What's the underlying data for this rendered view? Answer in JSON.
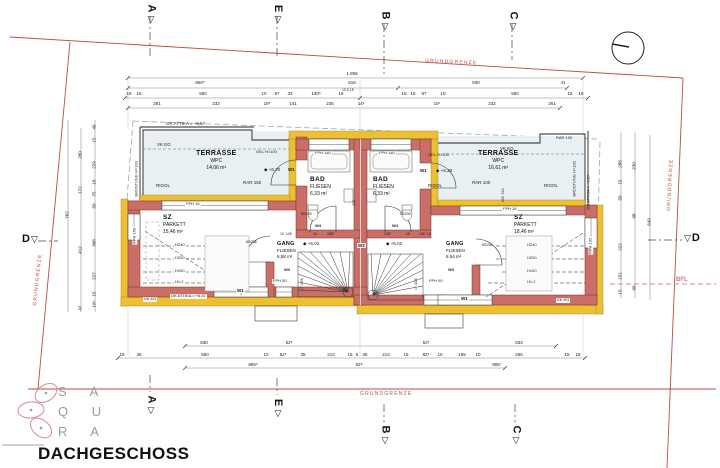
{
  "title": "DACHGESCHOSS",
  "logo": {
    "rows": [
      "S A",
      "Q U",
      "R A"
    ]
  },
  "boundary": {
    "grundgrenze_top": "GRUNDGRENZE",
    "grundgrenze_right": "GRUNDGRENZE",
    "grundgrenze_bottom": "GRUNDGRENZE",
    "grundgrenze_left": "GRUNDGRENZE",
    "bfl": "BFL"
  },
  "colors": {
    "wall": "#c96f68",
    "wall_outline": "#7a2f28",
    "insulation": "#edc033",
    "boundary": "#bf4a44",
    "bfl_line": "#e08a9a",
    "roof_dashed": "#85aec9",
    "terrace_floor": "#e9f0f4"
  },
  "section_markers": {
    "top": [
      {
        "label": "A"
      },
      {
        "label": "E"
      },
      {
        "label": "B"
      },
      {
        "label": "C"
      }
    ],
    "bottom": [
      {
        "label": "A"
      },
      {
        "label": "E"
      },
      {
        "label": "B"
      },
      {
        "label": "C"
      }
    ],
    "left": {
      "label": "D"
    },
    "right": {
      "label": "D"
    }
  },
  "rooms": [
    {
      "name": "TERRASSE",
      "finish": "WPC",
      "area": "14,06 m²"
    },
    {
      "name": "TERRASSE",
      "finish": "WPC",
      "area": "16,61 m²"
    },
    {
      "name": "BAD",
      "finish": "FLIESEN",
      "area": "6,33 m²"
    },
    {
      "name": "BAD",
      "finish": "FLIESEN",
      "area": "6,33 m²"
    },
    {
      "name": "SZ",
      "finish": "PARKETT",
      "area": "15,46 m²"
    },
    {
      "name": "SZ",
      "finish": "PARKETT",
      "area": "18,46 m²"
    },
    {
      "name": "GANG",
      "finish": "FLIESEN",
      "area": "6,58 m²"
    },
    {
      "name": "GANG",
      "finish": "FLIESEN",
      "area": "6,54 m²"
    }
  ],
  "labels": [
    {
      "n": "ok-attika-top",
      "t": "OK ATTIKA = +6,57",
      "x": 166,
      "y": 121,
      "s": 4.5
    },
    {
      "n": "vk-eg-terrace-left",
      "t": "VK EG",
      "x": 157,
      "y": 142,
      "s": 4.5
    },
    {
      "n": "bruestung-left",
      "t": "BRÜSTUNG H=100",
      "x": 139,
      "y": 192,
      "s": 4,
      "r": -90
    },
    {
      "n": "rigol-terrace-left",
      "t": "RIGOL",
      "x": 156,
      "y": 183,
      "s": 4.5
    },
    {
      "n": "rar-terrace-left",
      "t": "RAR 150",
      "x": 243,
      "y": 180,
      "s": 4.5
    },
    {
      "n": "gel-h100-left",
      "t": "GEL H=100",
      "x": 256,
      "y": 150,
      "s": 4
    },
    {
      "n": "level-620-left",
      "t": "◆ +6,20",
      "x": 264,
      "y": 167,
      "s": 4.5
    },
    {
      "n": "w1-terrace-left",
      "t": "W1",
      "x": 288,
      "y": 167,
      "s": 4.5,
      "b": 1
    },
    {
      "n": "rar-top-right",
      "t": "RAR 100",
      "x": 556,
      "y": 136,
      "s": 4
    },
    {
      "n": "gel-h100-right",
      "t": "GEL H=100",
      "x": 428,
      "y": 153,
      "s": 4
    },
    {
      "n": "w1-terrace-right",
      "t": "W1",
      "x": 420,
      "y": 168,
      "s": 4.5,
      "b": 1
    },
    {
      "n": "level-620-right",
      "t": "◆ +6,20",
      "x": 436,
      "y": 168,
      "s": 4.5
    },
    {
      "n": "vk-eg-terrace-right",
      "t": "VK EG",
      "x": 500,
      "y": 146,
      "s": 4.5
    },
    {
      "n": "rigol-terrace-right-1",
      "t": "RIGOL",
      "x": 428,
      "y": 183,
      "s": 4.5
    },
    {
      "n": "rar-terrace-right",
      "t": "RAR 100",
      "x": 472,
      "y": 180,
      "s": 4.5
    },
    {
      "n": "rigol-terrace-right-2",
      "t": "RIGOL",
      "x": 544,
      "y": 183,
      "s": 4.5
    },
    {
      "n": "bruestung-right",
      "t": "BRÜSTUNG H=100",
      "x": 577,
      "y": 192,
      "s": 4,
      "r": -90
    },
    {
      "n": "ok-attika-right",
      "t": "OK ATTIKA = +6,57",
      "x": 591,
      "y": 205,
      "s": 4,
      "r": -90
    },
    {
      "n": "fph140-left",
      "t": "FPH 140",
      "x": 314,
      "y": 151,
      "s": 4,
      "bg": 1
    },
    {
      "n": "fph140-right",
      "t": "FPH 140",
      "x": 378,
      "y": 151,
      "s": 4,
      "bg": 1
    },
    {
      "n": "w4-left",
      "t": "W4",
      "x": 315,
      "y": 224,
      "s": 4,
      "b": 1
    },
    {
      "n": "w4-right",
      "t": "W4",
      "x": 392,
      "y": 224,
      "s": 4,
      "b": 1
    },
    {
      "n": "door-80-230-left",
      "t": "80/230",
      "x": 301,
      "y": 212,
      "s": 3.5
    },
    {
      "n": "door-80-230-right",
      "t": "80/230",
      "x": 400,
      "y": 212,
      "s": 3.5
    },
    {
      "n": "fph16-left",
      "t": "FPH 16",
      "x": 185,
      "y": 202,
      "s": 4,
      "bg": 1
    },
    {
      "n": "fph16-right",
      "t": "FPH 16",
      "x": 502,
      "y": 207,
      "s": 4,
      "bg": 1
    },
    {
      "n": "fph150-left",
      "t": "FPH 150",
      "x": 137,
      "y": 240,
      "s": 4,
      "r": -90,
      "bg": 1
    },
    {
      "n": "fph132-right",
      "t": "FPH 132",
      "x": 593,
      "y": 250,
      "s": 4,
      "r": -90,
      "bg": 1
    },
    {
      "n": "h240-left",
      "t": "H240",
      "x": 174,
      "y": 243,
      "s": 4,
      "bg": 1
    },
    {
      "n": "h200-left",
      "t": "H200",
      "x": 174,
      "y": 256,
      "s": 4,
      "bg": 1
    },
    {
      "n": "h150-left",
      "t": "H150",
      "x": 174,
      "y": 269,
      "s": 4,
      "bg": 1
    },
    {
      "n": "h12-left",
      "t": "H1:2",
      "x": 174,
      "y": 280,
      "s": 4,
      "bg": 1
    },
    {
      "n": "h240-right",
      "t": "H240",
      "x": 526,
      "y": 243,
      "s": 4,
      "bg": 1
    },
    {
      "n": "h200-right",
      "t": "H200",
      "x": 526,
      "y": 256,
      "s": 4,
      "bg": 1
    },
    {
      "n": "h150-right",
      "t": "H150",
      "x": 526,
      "y": 269,
      "s": 4,
      "bg": 1
    },
    {
      "n": "h12-right",
      "t": "H1:2",
      "x": 526,
      "y": 280,
      "s": 4,
      "bg": 1
    },
    {
      "n": "door-80-206-left",
      "t": "80/206",
      "x": 246,
      "y": 240,
      "s": 3.5
    },
    {
      "n": "door-80-206-right",
      "t": "80/206",
      "x": 482,
      "y": 243,
      "s": 3.5
    },
    {
      "n": "w3-left",
      "t": "W3",
      "x": 284,
      "y": 268,
      "s": 4,
      "b": 1
    },
    {
      "n": "w3-right",
      "t": "W3",
      "x": 448,
      "y": 268,
      "s": 4,
      "b": 1
    },
    {
      "n": "fph50-left",
      "t": "FPH 50",
      "x": 272,
      "y": 279,
      "s": 4,
      "bg": 1
    },
    {
      "n": "fph90-right",
      "t": "FPH 90",
      "x": 428,
      "y": 279,
      "s": 4,
      "bg": 1
    },
    {
      "n": "level-602-left",
      "t": "◆ +6,02",
      "x": 303,
      "y": 241,
      "s": 4.5
    },
    {
      "n": "level-602-right",
      "t": "◆ +6,02",
      "x": 386,
      "y": 241,
      "s": 4.5
    },
    {
      "n": "w2-center",
      "t": "W2",
      "x": 357,
      "y": 243,
      "s": 4.5,
      "b": 1,
      "bg": 1
    },
    {
      "n": "stair-left-steps",
      "t": "17,4/26",
      "x": 304,
      "y": 286,
      "s": 3.5,
      "r": -90
    },
    {
      "n": "stair-right-steps",
      "t": "17,4/26",
      "x": 418,
      "y": 286,
      "s": 3.5,
      "r": -90
    },
    {
      "n": "vk-eg-south-left",
      "t": "VK EG",
      "x": 143,
      "y": 297,
      "s": 4,
      "bg": 1
    },
    {
      "n": "ok-attika-south",
      "t": "OK ATTIKA = +6,37",
      "x": 170,
      "y": 294,
      "s": 4,
      "bg": 1
    },
    {
      "n": "w1-south-left",
      "t": "W1",
      "x": 236,
      "y": 288,
      "s": 4.5,
      "b": 1,
      "bg": 1
    },
    {
      "n": "w1-south-right",
      "t": "W1",
      "x": 460,
      "y": 296,
      "s": 4.5,
      "b": 1,
      "bg": 1
    },
    {
      "n": "vk-eg-south-right",
      "t": "VK EG",
      "x": 556,
      "y": 298,
      "s": 4,
      "bg": 1
    },
    {
      "n": "dim-15-5-15",
      "t": "15 5 15",
      "x": 342,
      "y": 88,
      "s": 3.5
    },
    {
      "n": "dim-10-105-left",
      "t": "10  105",
      "x": 280,
      "y": 232,
      "s": 3.5
    },
    {
      "n": "dim-15-gang-left",
      "t": "15",
      "x": 313,
      "y": 232,
      "s": 3.5
    },
    {
      "n": "dim-2085-left",
      "t": "208⁵",
      "x": 327,
      "y": 232,
      "s": 3.5
    },
    {
      "n": "dim-2085-right",
      "t": "208⁵",
      "x": 384,
      "y": 232,
      "s": 3.5
    },
    {
      "n": "dim-15-gang-right",
      "t": "15",
      "x": 406,
      "y": 232,
      "s": 3.5
    },
    {
      "n": "dim-105-10-right",
      "t": "105  10",
      "x": 419,
      "y": 232,
      "s": 3.5
    },
    {
      "n": "dim-250-210",
      "t": "250  210",
      "x": 505,
      "y": 198,
      "s": 3.5,
      "r": -90
    },
    {
      "n": "dim-200-party",
      "t": "200",
      "x": 356,
      "y": 202,
      "s": 3.5,
      "r": -90
    }
  ],
  "dimensions": {
    "rows": [
      {
        "y": 74,
        "items": [
          {
            "v": "1.898",
            "x": 352
          }
        ]
      },
      {
        "y": 83,
        "items": [
          {
            "v": "850⁵",
            "x": 200
          },
          {
            "v": "518",
            "x": 352
          },
          {
            "v": "830",
            "x": 476
          },
          {
            "v": "41",
            "x": 563
          }
        ]
      },
      {
        "y": 94,
        "items": [
          {
            "v": "18",
            "x": 129
          },
          {
            "v": "15",
            "x": 139
          },
          {
            "v": "560",
            "x": 203
          },
          {
            "v": "10",
            "x": 264
          },
          {
            "v": "87",
            "x": 277
          },
          {
            "v": "33",
            "x": 290
          },
          {
            "v": "130⁵",
            "x": 316
          },
          {
            "v": "18",
            "x": 341
          },
          {
            "v": "15",
            "x": 404
          },
          {
            "v": "18",
            "x": 413
          },
          {
            "v": "87",
            "x": 424
          },
          {
            "v": "10",
            "x": 443
          },
          {
            "v": "560",
            "x": 515
          },
          {
            "v": "15",
            "x": 570
          },
          {
            "v": "18",
            "x": 581
          }
        ]
      },
      {
        "y": 104,
        "items": [
          {
            "v": "361",
            "x": 157
          },
          {
            "v": "232",
            "x": 216
          },
          {
            "v": "18⁵",
            "x": 267
          },
          {
            "v": "141",
            "x": 293
          },
          {
            "v": "236",
            "x": 330
          },
          {
            "v": "14¹",
            "x": 361
          },
          {
            "v": "19⁷",
            "x": 437
          },
          {
            "v": "232",
            "x": 492
          },
          {
            "v": "261",
            "x": 552
          }
        ]
      },
      {
        "y": 343,
        "items": [
          {
            "v": "830",
            "x": 204
          },
          {
            "v": "52⁵",
            "x": 289
          },
          {
            "v": "52¹",
            "x": 426
          },
          {
            "v": "633",
            "x": 519
          }
        ]
      },
      {
        "y": 355,
        "items": [
          {
            "v": "18",
            "x": 122
          },
          {
            "v": "35",
            "x": 139
          },
          {
            "v": "560",
            "x": 205
          },
          {
            "v": "10",
            "x": 266
          },
          {
            "v": "82⁵",
            "x": 283
          },
          {
            "v": "35",
            "x": 303
          },
          {
            "v": "212",
            "x": 331
          },
          {
            "v": "15",
            "x": 350
          },
          {
            "v": "5",
            "x": 357
          },
          {
            "v": "35",
            "x": 365
          },
          {
            "v": "213",
            "x": 386
          },
          {
            "v": "15",
            "x": 406
          },
          {
            "v": "82⁵",
            "x": 426
          },
          {
            "v": "10",
            "x": 440
          },
          {
            "v": "185",
            "x": 462
          },
          {
            "v": "10",
            "x": 478
          },
          {
            "v": "265",
            "x": 519
          },
          {
            "v": "15",
            "x": 567
          },
          {
            "v": "18",
            "x": 578
          }
        ]
      },
      {
        "y": 365,
        "items": [
          {
            "v": "885⁵",
            "x": 253
          },
          {
            "v": "52⁵",
            "x": 359
          },
          {
            "v": "885⁷",
            "x": 497
          }
        ]
      }
    ],
    "cols": [
      {
        "x": 67,
        "items": [
          {
            "v": "762",
            "y": 215
          }
        ]
      },
      {
        "x": 80,
        "items": [
          {
            "v": "280",
            "y": 155
          },
          {
            "v": "172",
            "y": 190
          },
          {
            "v": "412",
            "y": 250
          },
          {
            "v": "47",
            "y": 308
          }
        ]
      },
      {
        "x": 94,
        "items": [
          {
            "v": "49",
            "y": 127
          },
          {
            "v": "15",
            "y": 140
          },
          {
            "v": "229",
            "y": 165
          },
          {
            "v": "18",
            "y": 182
          },
          {
            "v": "75",
            "y": 194
          },
          {
            "v": "50",
            "y": 206
          },
          {
            "v": "308",
            "y": 243
          },
          {
            "v": "227",
            "y": 276
          },
          {
            "v": "15",
            "y": 294
          },
          {
            "v": "18⁵",
            "y": 304
          }
        ]
      },
      {
        "x": 620,
        "items": [
          {
            "v": "288",
            "y": 164
          },
          {
            "v": "15",
            "y": 182
          },
          {
            "v": "50",
            "y": 198
          },
          {
            "v": "222",
            "y": 247
          },
          {
            "v": "151",
            "y": 276
          },
          {
            "v": "15",
            "y": 292
          }
        ]
      },
      {
        "x": 634,
        "items": [
          {
            "v": "230",
            "y": 166
          },
          {
            "v": "98",
            "y": 216
          },
          {
            "v": "96",
            "y": 288
          }
        ]
      },
      {
        "x": 649,
        "items": [
          {
            "v": "649",
            "y": 222
          }
        ]
      }
    ]
  }
}
